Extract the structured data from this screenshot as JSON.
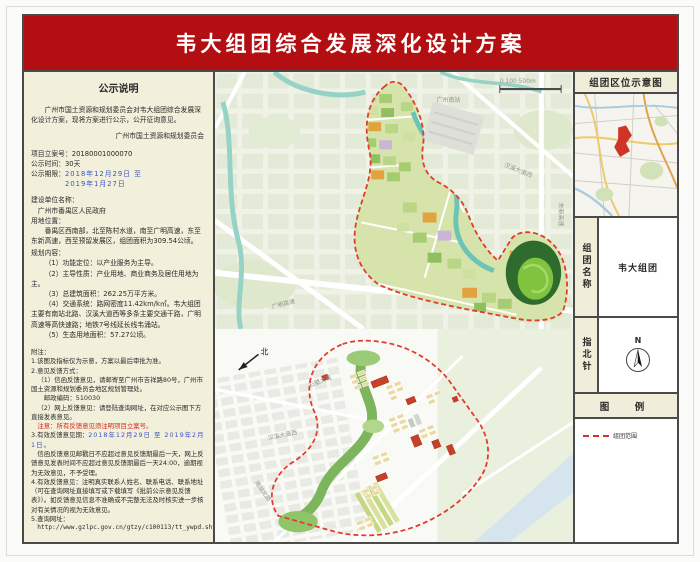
{
  "title": "韦大组团综合发展深化设计方案",
  "colors": {
    "banner_red": "#b30f12",
    "boundary_red": "#e23a2b",
    "panel_cream": "#f2efdb",
    "date_blue": "#3a56c4",
    "warn_red": "#d3281c"
  },
  "notice": {
    "heading": "公示说明",
    "intro": "广州市国土资源和规划委员会对韦大组团综合发展深化设计方案，现将方案进行公示，公开征询意见。",
    "agency": "广州市国土资源和规划委员会",
    "case_no": "项目立案号：20180001000070",
    "duration": "公示时间：30天",
    "period_label": "公示期限：",
    "period_line1": "2018年12月29日 至",
    "period_line2": "2019年1月27日",
    "builder_label": "建设单位名称：",
    "builder_value": "广州市番禺区人民政府",
    "site_label": "用地位置：",
    "site_value": "番禺区西南部，北至陈村水道，南至广明高速，东至东新高速，西至预留发展区，组团面积为309.54公顷。",
    "plan_label": "规划内容：",
    "plan_items": [
      "（1）功能定位：以产业服务为主导。",
      "（2）主导性质：产业用地、商业商务及居住用地为主。",
      "（3）总建筑面积：262.25万平方米。",
      "（4）交通系统：路网密度11.42km/k㎡。韦大组团主要有南站北路、汉溪大道西等多条主要交通干路，广明高速等高快速路；地铁7号线延长线韦涌站。",
      "（5）生态用地面积：57.27公顷。"
    ],
    "notes": {
      "label": "附注：",
      "n1": "1.该图及指标仅为示意，方案以最后审批为准。",
      "n2": "2.意见反馈方式：",
      "n2_1": "（1）信函反馈意见，请邮寄至广州市吉祥路80号，广州市国土资源和规划委员会地区规划管理处。",
      "n2_zip": "邮政编码：510030",
      "n2_2": "（2）网上反馈意见：请登陆查询网址，在对应公示图下方直接发表意见。",
      "n2_warn": "注意：所有反馈意见须注明项目立案号。",
      "n3_label": "3.有效反馈意见期：",
      "n3_dates": "2018年12月29日 至 2019年2月1日。",
      "n3_text": "信函反馈意见邮戳日不应超过意见反馈期最后一天，网上反馈意见发表时间不应超过意见反馈期最后一天24:00，逾期视为无效意见，不予受理。",
      "n4": "4.有效反馈意见：注明真实联系人姓名、联系电话、联系地址（可在查询网址直接填写或下载填写《批前公示意见反馈表》）。如反馈意见信息不准确或不完整无法及时核实进一步核对有关情况的视为无效意见。",
      "n5_label": "5.查询网址：",
      "n5_url": "http://www.gzlpc.gov.cn/gtzy/c100113/tt_ywpd.shtml"
    }
  },
  "maps": {
    "top": {
      "station": "广州南站",
      "scale": "0 100 500m",
      "road_east": "东新高速",
      "road_south": "广明高速",
      "road_mid": "汉溪大道西"
    },
    "bottom": {
      "north": "北",
      "road_hanxi": "汉溪大道西",
      "road_nanzhan": "南站北路",
      "road_shibi": "石壁大道"
    }
  },
  "side": {
    "location_title": "组团区位示意图",
    "name_label": "组团名称",
    "name_value": "韦大组团",
    "compass_label": "指北针",
    "compass_n": "N",
    "legend_title": "图　例",
    "legend_boundary_label": "组团范围"
  }
}
